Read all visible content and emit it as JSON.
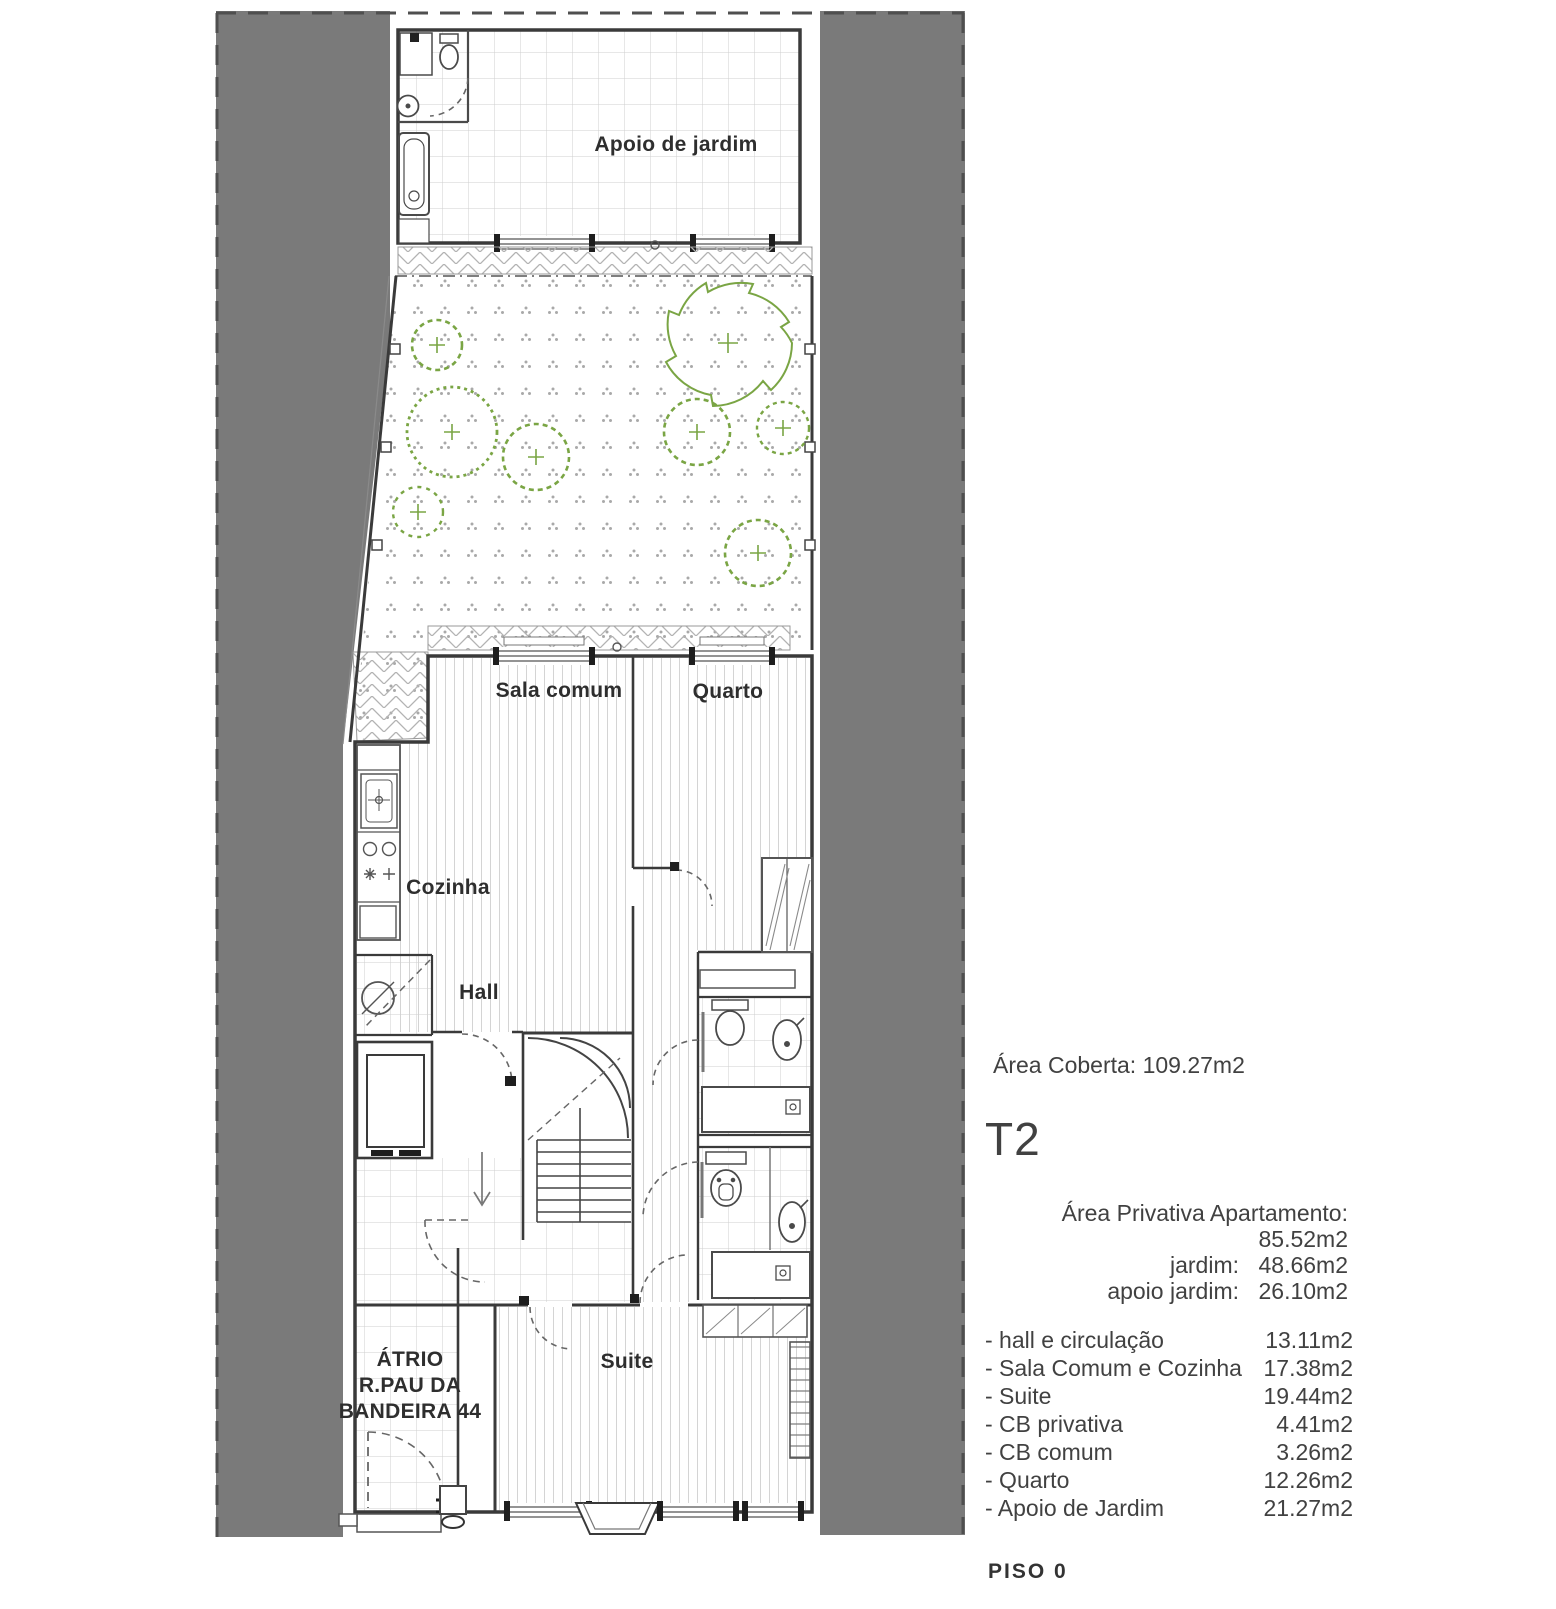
{
  "plan": {
    "labels": {
      "apoio": "Apoio de jardim",
      "sala": "Sala comum",
      "quarto": "Quarto",
      "cozinha": "Cozinha",
      "hall": "Hall",
      "suite": "Suite",
      "atrio_line1": "ÁTRIO",
      "atrio_line2": "R.PAU DA",
      "atrio_line3": "BANDEIRA 44"
    }
  },
  "sidebar": {
    "area_coberta": "Área Coberta: 109.27m2",
    "unit_type": "T2",
    "private_areas": [
      {
        "label": "Área Privativa Apartamento:",
        "value": "85.52m2"
      },
      {
        "label": "jardim:",
        "value": "48.66m2"
      },
      {
        "label": "apoio jardim:",
        "value": "26.10m2"
      }
    ],
    "rooms": [
      {
        "label": "- hall e circulação",
        "value": "13.11m2"
      },
      {
        "label": "- Sala Comum e Cozinha",
        "value": "17.38m2"
      },
      {
        "label": "- Suite",
        "value": "19.44m2"
      },
      {
        "label": "- CB privativa",
        "value": "4.41m2"
      },
      {
        "label": "- CB comum",
        "value": "3.26m2"
      },
      {
        "label": "- Quarto",
        "value": "12.26m2"
      },
      {
        "label": "- Apoio de Jardim",
        "value": "21.27m2"
      }
    ],
    "floor_label": "PISO 0"
  },
  "colors": {
    "neighbour_band": "#7a7a7a",
    "wall": "#3a3a3a",
    "tree_green": "#7aa544"
  }
}
